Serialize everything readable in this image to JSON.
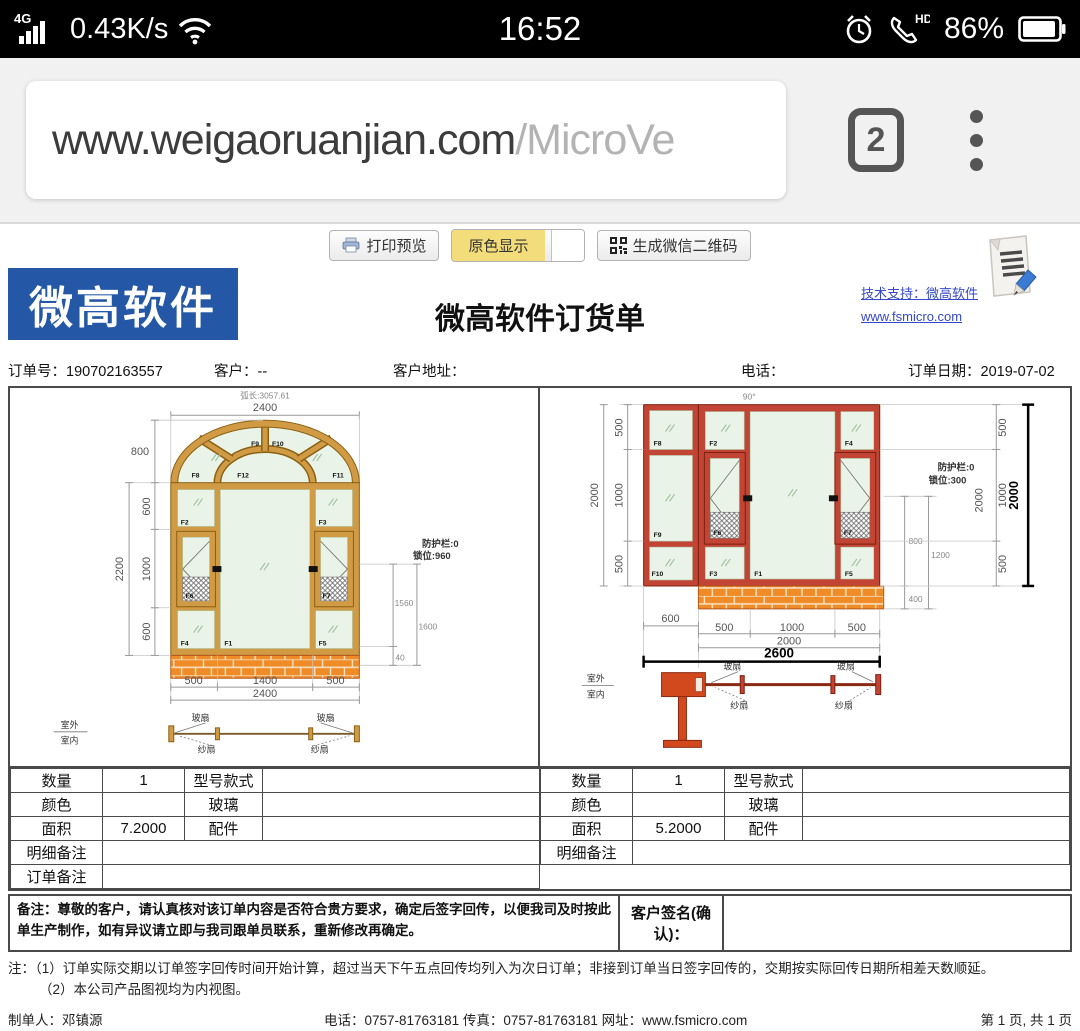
{
  "status_bar": {
    "network": "4G",
    "speed": "0.43K/s",
    "time": "16:52",
    "hd": "HD",
    "battery": "86%"
  },
  "browser": {
    "url_host": "www.weigaoruanjian.com",
    "url_path": "/MicroVe",
    "tab_count": "2"
  },
  "toolbar": {
    "print_preview": "打印预览",
    "original_color": "原色显示",
    "generate_qr": "生成微信二维码"
  },
  "header": {
    "logo": "微高软件",
    "title": "微高软件订货单",
    "support_link": "技术支持：微高软件",
    "website_link": "www.fsmicro.com"
  },
  "order_info": {
    "order_no": "订单号：190702163557",
    "customer": "客户：--",
    "address": "客户地址：",
    "phone": "电话：",
    "date": "订单日期：2019-07-02"
  },
  "left_drawing": {
    "arc_length": "弧长:3057.61",
    "width_top": "2400",
    "arch_height": "800",
    "height_total": "2200",
    "row_heights": [
      "600",
      "1000",
      "600"
    ],
    "guard": "防护栏:0",
    "lock": "锁位:960",
    "lock_dims": [
      "1560",
      "1600",
      "40"
    ],
    "col_widths": [
      "500",
      "1400",
      "500"
    ],
    "width_bottom": "2400",
    "panels": {
      "f1": "F1",
      "f2": "F2",
      "f3": "F3",
      "f4": "F4",
      "f5": "F5",
      "f6": "F6",
      "f7": "F7",
      "f8": "F8",
      "f9": "F9",
      "f10": "F10",
      "f11": "F11",
      "f12": "F12"
    },
    "section": {
      "outside": "室外",
      "inside": "室内",
      "glass": "玻扇",
      "screen": "纱扇"
    }
  },
  "right_drawing": {
    "angle": "90°",
    "height_total": "2000",
    "row_heights": [
      "500",
      "1000",
      "500"
    ],
    "right_chain": [
      "500",
      "1000",
      "500"
    ],
    "right_chain_total": "2000",
    "right_total_bold": "2000",
    "guard": "防护栏:0",
    "lock": "锁位:300",
    "lock_dims": [
      "800",
      "1200",
      "400"
    ],
    "bottom_left": "600",
    "col_widths": [
      "500",
      "1000",
      "500"
    ],
    "bottom_mid": "2000",
    "bottom_total": "2600",
    "panels": {
      "f1": "F1",
      "f2": "F2",
      "f3": "F3",
      "f4": "F4",
      "f5": "F5",
      "f6": "F6",
      "f7": "F7",
      "f8": "F8",
      "f9": "F9",
      "f10": "F10"
    },
    "section": {
      "outside": "室外",
      "inside": "室内",
      "glass": "玻扇",
      "screen": "纱扇"
    }
  },
  "tables": {
    "left": {
      "qty_label": "数量",
      "qty": "1",
      "model_label": "型号款式",
      "color_label": "颜色",
      "glass_label": "玻璃",
      "area_label": "面积",
      "area": "7.2000",
      "parts_label": "配件",
      "detail_label": "明细备注",
      "order_label": "订单备注"
    },
    "right": {
      "qty_label": "数量",
      "qty": "1",
      "model_label": "型号款式",
      "color_label": "颜色",
      "glass_label": "玻璃",
      "area_label": "面积",
      "area": "5.2000",
      "parts_label": "配件",
      "detail_label": "明细备注"
    }
  },
  "remark": {
    "text": "备注：尊敬的客户，请认真核对该订单内容是否符合贵方要求，确定后签字回传，以便我司及时按此单生产制作，如有异议请立即与我司跟单员联系，重新修改再确定。",
    "signature_label": "客户签名(确认)："
  },
  "notes": {
    "line1": "注：（1）订单实际交期以订单签字回传时间开始计算，超过当天下午五点回传均列入为次日订单；非接到订单当日签字回传的，交期按实际回传日期所相差天数顺延。",
    "line2": "（2）本公司产品图视均为内视图。"
  },
  "footer": {
    "maker": "制单人：邓镇源",
    "contact": "电话：0757-81763181 传真：0757-81763181 网址：www.fsmicro.com",
    "pages": "第 1 页, 共 1 页"
  },
  "colors": {
    "logo_bg": "#2458A6",
    "link_blue": "#3548c9",
    "button_yellow": "#f3dd7a",
    "left_frame_wood": "#D19A45",
    "right_frame_red": "#C14434",
    "glass": "#E9F3E7",
    "brick": "#F08C28"
  }
}
